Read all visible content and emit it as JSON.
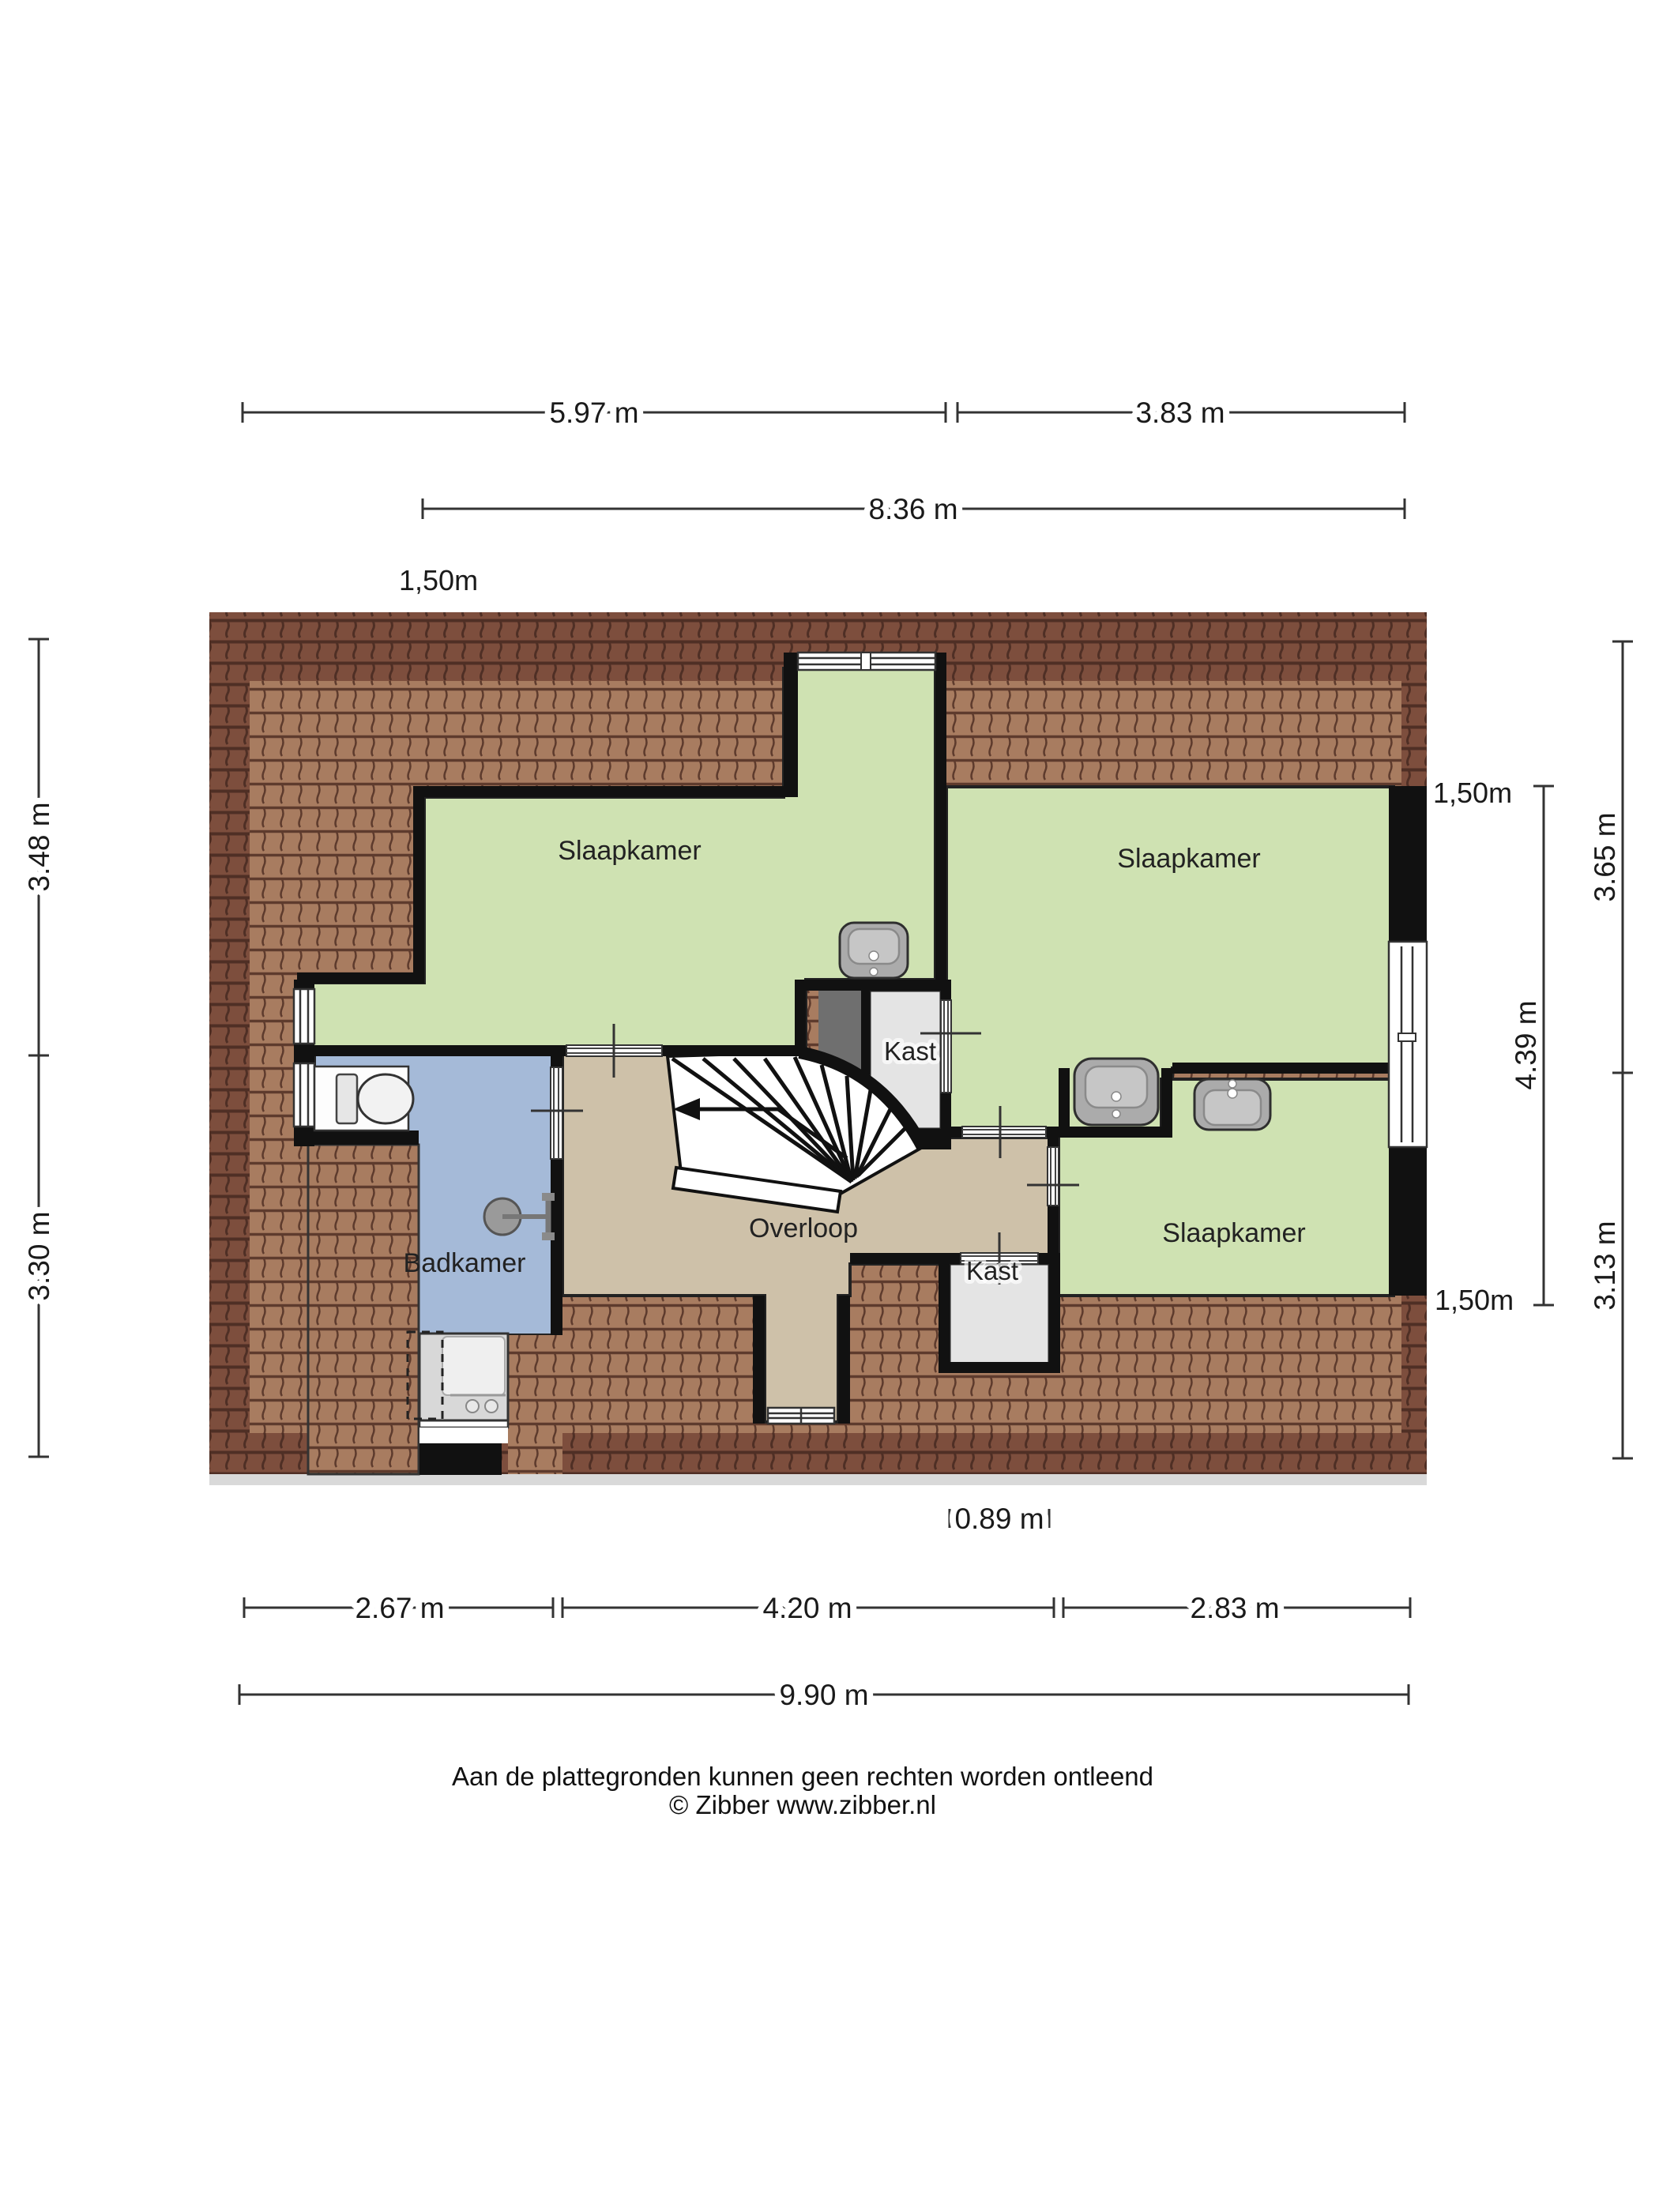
{
  "floorplan": {
    "rooms": {
      "bedroom_left": "Slaapkamer",
      "bedroom_right": "Slaapkamer",
      "bedroom_bottom": "Slaapkamer",
      "bathroom": "Badkamer",
      "landing": "Overloop",
      "closet_top": "Kast",
      "closet_bottom": "Kast"
    },
    "dimensions": {
      "top_width_left": "5.97 m",
      "top_width_right": "3.83 m",
      "top_width_total": "8.36 m",
      "knee_top_left": "1,50m",
      "left_height_top": "3.48 m",
      "left_height_bottom": "3.30 m",
      "right_knee_top": "1,50m",
      "right_height_top": "3.65 m",
      "right_height_middle": "4.39 m",
      "right_height_bottom": "3.13 m",
      "right_knee_bottom": "1,50m",
      "bottom_closet_width": "0.89 m",
      "bottom_width_left": "2.67 m",
      "bottom_width_middle": "4.20 m",
      "bottom_width_right": "2.83 m",
      "bottom_width_total": "9.90 m"
    },
    "colors": {
      "room-green": "#cfe2b2",
      "room-blue": "#a5bad8",
      "room-tan": "#cec1a9",
      "closet-gray": "#e4e4e4",
      "void-gray": "#6f6f6f",
      "roof-dark": "#7d4e3d",
      "roof-dark-line": "#4f2f25",
      "roof-light": "#a87c60",
      "roof-light-line": "#5e3b2d",
      "wall-black": "#111111",
      "fixture-gray": "#ababab"
    }
  },
  "footer": {
    "disclaimer": "Aan de plattegronden kunnen geen rechten worden ontleend",
    "credit": "© Zibber www.zibber.nl"
  }
}
